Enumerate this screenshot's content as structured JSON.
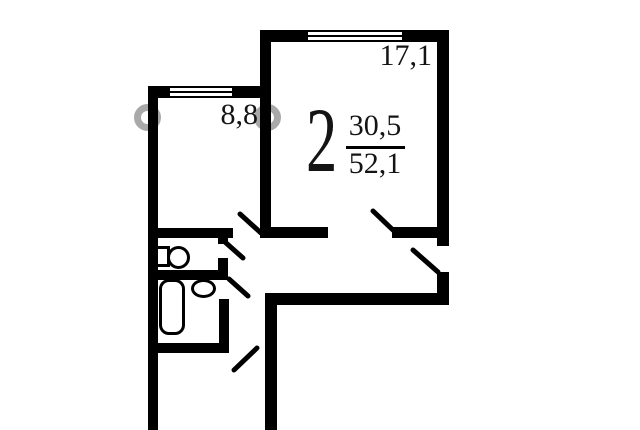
{
  "plan": {
    "title": "2-room apartment floor plan",
    "rooms": [
      {
        "name": "living-room",
        "area_label": "17,1"
      },
      {
        "name": "kitchen",
        "area_label": "8,8"
      }
    ],
    "summary": {
      "rooms_count": "2",
      "living_area": "30,5",
      "total_area": "52,1"
    },
    "fixtures": [
      "toilet",
      "bathtub",
      "sink"
    ],
    "features": [
      "window-living-room",
      "window-kitchen",
      "door-living-room",
      "door-hall",
      "door-kitchen",
      "door-wc",
      "door-bath",
      "door-entry"
    ]
  },
  "colors": {
    "wall": "#000000",
    "background": "#ffffff",
    "text": "#141414",
    "watermark": "#9a9a9a"
  }
}
